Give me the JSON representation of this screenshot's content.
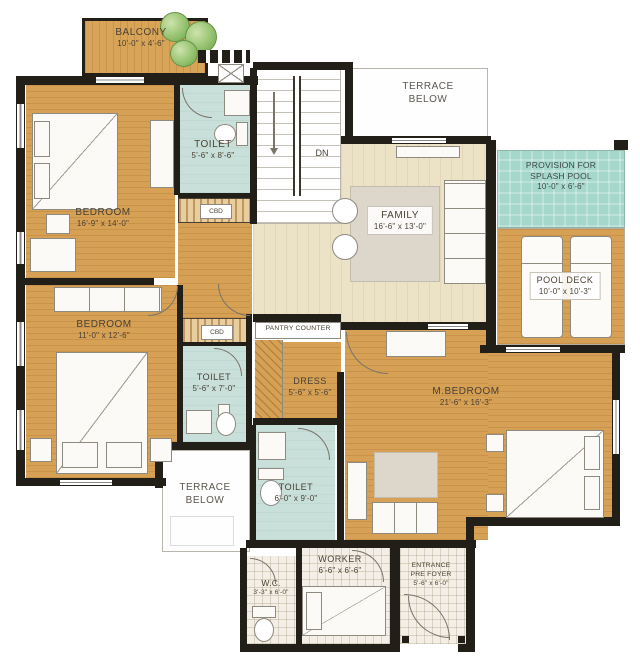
{
  "plan": {
    "balcony": {
      "name": "BALCONY",
      "dims": "10'-0\" x 4'-6\""
    },
    "bedroom_top": {
      "name": "BEDROOM",
      "dims": "16'-9\" x 14'-0\""
    },
    "toilet_top": {
      "name": "TOILET",
      "dims": "5'-6\" x 8'-6\""
    },
    "cbd_top": {
      "label": "CBD"
    },
    "stairs": {
      "dn": "DN"
    },
    "terrace_top": {
      "line1": "TERRACE",
      "line2": "BELOW"
    },
    "family": {
      "name": "FAMILY",
      "dims": "16'-6\" x 13'-0\""
    },
    "splash_pool": {
      "line1": "PROVISION FOR",
      "line2": "SPLASH POOL",
      "dims": "10'-0\" x 6'-6\""
    },
    "pool_deck": {
      "name": "POOL DECK",
      "dims": "10'-0\" x 10'-3\""
    },
    "bedroom_mid": {
      "name": "BEDROOM",
      "dims": "11'-0\" x 12'-6\""
    },
    "cbd_mid": {
      "label": "CBD"
    },
    "toilet_mid": {
      "name": "TOILET",
      "dims": "5'-6\" x 7'-0\""
    },
    "pantry": {
      "label": "PANTRY COUNTER"
    },
    "dress": {
      "name": "DRESS",
      "dims": "5'-6\" x 5'-6\""
    },
    "master_bedroom": {
      "name": "M.BEDROOM",
      "dims": "21'-6\" x 16'-3\""
    },
    "terrace_bottom": {
      "line1": "TERRACE",
      "line2": "BELOW"
    },
    "toilet_master": {
      "name": "TOILET",
      "dims": "6'-0\" x 9'-0\""
    },
    "wc": {
      "name": "W.C.",
      "dims": "3'-3\" x 6'-0\""
    },
    "worker": {
      "name": "WORKER",
      "dims": "6'-6\" x 6'-6\""
    },
    "foyer": {
      "line1": "ENTRANCE",
      "line2": "PRE FOYER",
      "dims": "5'-6\" x 6'-0\""
    }
  },
  "colors": {
    "wall": "#221e18",
    "wood_floor": "#d6a055",
    "family_floor": "#ece3c6",
    "toilet_floor": "#c9e0da",
    "splash_pool": "#a6d7cb",
    "tile_floor": "#f3efe6",
    "cupboard": "#e8cd9e",
    "tree": "#8fbf6a",
    "label_text": "#4a4134"
  }
}
